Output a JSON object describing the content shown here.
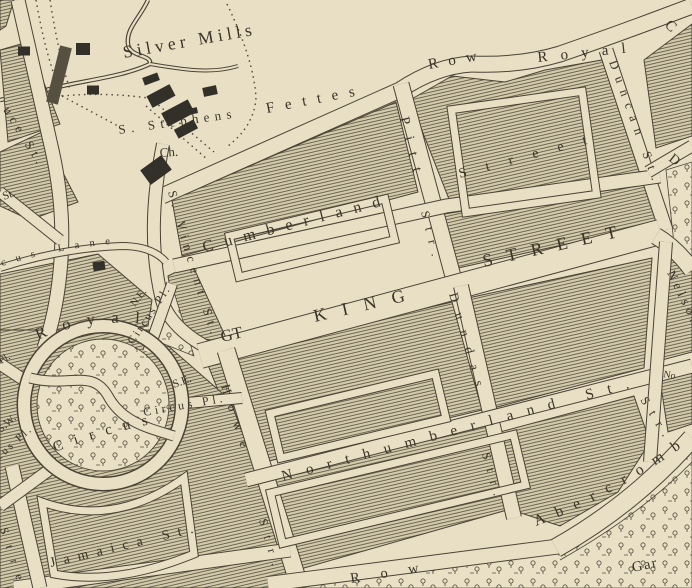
{
  "map": {
    "description": "Engraved antique town-plan map section",
    "palette": {
      "paper": "#e8dfc4",
      "block_fill": "#d3c9ab",
      "hatch_line": "#56503e",
      "ink": "#3a3428",
      "edge": "#4a4335",
      "building": "#33302a"
    },
    "labels": {
      "silver_mills": {
        "text": "Silver Mills"
      },
      "s_stephens": {
        "text": "S. Stephens"
      },
      "ch": {
        "text": "Ch."
      },
      "fettes": {
        "text": "Fettes"
      },
      "row_fettes": {
        "text": "Row"
      },
      "royal_crescent": {
        "text": "Royal"
      },
      "crescent_c": {
        "text": "C"
      },
      "duncan": {
        "text": "Duncan St."
      },
      "street_cumberland_e": {
        "text": "Street"
      },
      "pitt": {
        "text": "Pitt"
      },
      "pitt_str": {
        "text": "Str."
      },
      "cumberland": {
        "text": "Cumberland"
      },
      "s_vincent": {
        "text": "S. Vincent St."
      },
      "gt": {
        "text": "GT"
      },
      "king": {
        "text": "KING"
      },
      "street_gtking": {
        "text": "STREET"
      },
      "dundas": {
        "text": "Dundas"
      },
      "dundas_str": {
        "text": "Str."
      },
      "howe": {
        "text": "Howe"
      },
      "howe_str": {
        "text": "Str."
      },
      "ne": {
        "text": "N.E."
      },
      "ne_circus_pl": {
        "text": "Circus Pl."
      },
      "se": {
        "text": "S.E."
      },
      "se_circus_pl": {
        "text": "Circus Pl."
      },
      "sw": {
        "text": "S.W."
      },
      "sw_circus_pl": {
        "text": "Circus Pl."
      },
      "royal_circus": {
        "text": "Royal"
      },
      "circus": {
        "text": "Circus"
      },
      "pl_west": {
        "text": "Pl."
      },
      "circus_lane": {
        "text": "cus Lane"
      },
      "uce_st": {
        "text": "uce St."
      },
      "st_fragment": {
        "text": "St."
      },
      "northumberland": {
        "text": "Northumberland St."
      },
      "abercromby": {
        "text": "Abercromb"
      },
      "garden": {
        "text": "Gar"
      },
      "heriot_row": {
        "text": "Row"
      },
      "nelson": {
        "text": "Nelson"
      },
      "nelson_str": {
        "text": "Str."
      },
      "no_fragment": {
        "text": "No"
      },
      "d_fragment": {
        "text": "D"
      },
      "jamaica": {
        "text": "Jamaica St."
      },
      "street_fragment_sw": {
        "text": "Stre"
      }
    }
  }
}
